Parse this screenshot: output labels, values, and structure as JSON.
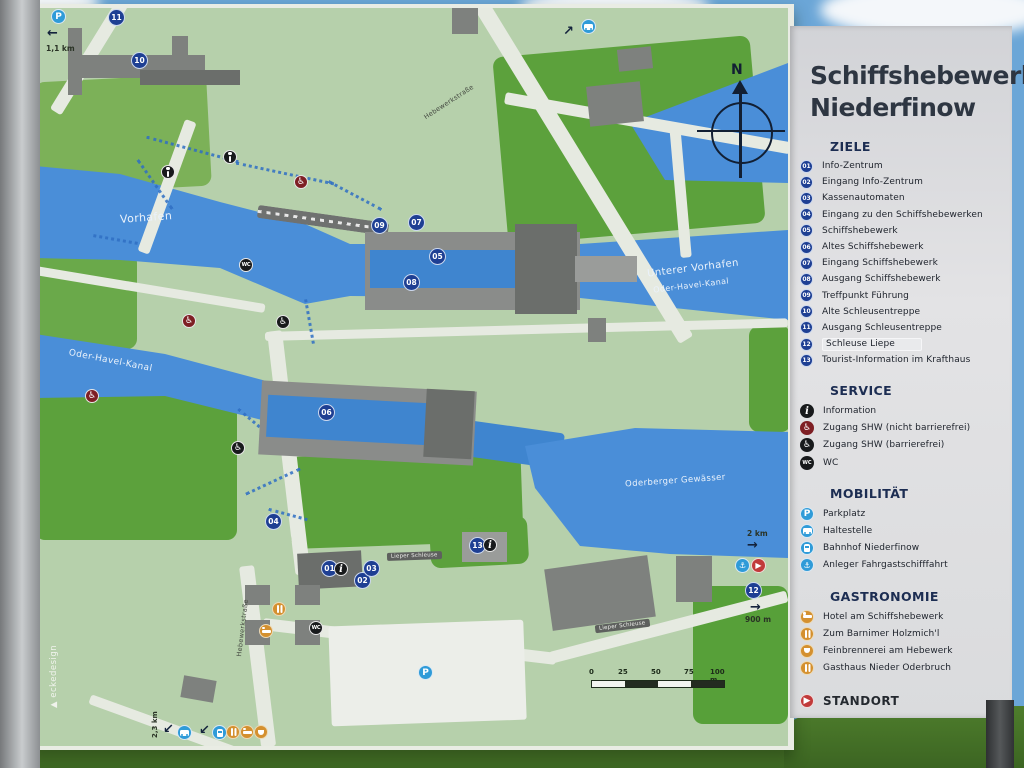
{
  "title": {
    "line1": "Schiffshebewerke",
    "line2": "Niederfinow"
  },
  "legend": {
    "ziele": {
      "header": "ZIELE",
      "items": [
        {
          "num": "01",
          "label": "Info-Zentrum"
        },
        {
          "num": "02",
          "label": "Eingang Info-Zentrum"
        },
        {
          "num": "03",
          "label": "Kassenautomaten"
        },
        {
          "num": "04",
          "label": "Eingang zu den Schiffshebewerken"
        },
        {
          "num": "05",
          "label": "Schiffshebewerk"
        },
        {
          "num": "06",
          "label": "Altes Schiffshebewerk"
        },
        {
          "num": "07",
          "label": "Eingang Schiffshebewerk"
        },
        {
          "num": "08",
          "label": "Ausgang Schiffshebewerk"
        },
        {
          "num": "09",
          "label": "Treffpunkt Führung"
        },
        {
          "num": "10",
          "label": "Alte Schleusentreppe"
        },
        {
          "num": "11",
          "label": "Ausgang Schleusentreppe"
        },
        {
          "num": "12",
          "label": "Schleuse Liepe"
        },
        {
          "num": "13",
          "label": "Tourist-Information im Krafthaus"
        }
      ]
    },
    "service": {
      "header": "SERVICE",
      "items": [
        {
          "label": "Information"
        },
        {
          "label": "Zugang SHW (nicht barrierefrei)"
        },
        {
          "label": "Zugang SHW (barrierefrei)"
        },
        {
          "label": "WC"
        }
      ]
    },
    "mobilitaet": {
      "header": "MOBILITÄT",
      "items": [
        {
          "label": "Parkplatz"
        },
        {
          "label": "Haltestelle"
        },
        {
          "label": "Bahnhof Niederfinow"
        },
        {
          "label": "Anleger Fahrgastschifffahrt"
        }
      ]
    },
    "gastronomie": {
      "header": "GASTRONOMIE",
      "items": [
        {
          "label": "Hotel am Schiffshebewerk"
        },
        {
          "label": "Zum Barnimer Holzmich'l"
        },
        {
          "label": "Feinbrennerei am Hebewerk"
        },
        {
          "label": "Gasthaus Nieder Oderbruch"
        }
      ]
    },
    "standort": {
      "label": "STANDORT"
    }
  },
  "map": {
    "water_labels": {
      "vorhafen": "Vorhafen",
      "unterer_vorhafen": "Unterer Vorhafen",
      "oder_havel_kanal": "Oder-Havel-Kanal",
      "oder_havel_kanal_west": "Oder-Havel-Kanal",
      "oderberger_gewaesser": "Oderberger Gewässer"
    },
    "road_labels": {
      "hebewerkstrasse_north": "Hebewerkstraße",
      "hebewerkstrasse_south": "Hebewerkstraße",
      "lieper_schleuse_1": "Lieper Schleuse",
      "lieper_schleuse_2": "Lieper Schleuse"
    },
    "markers": [
      "11",
      "10",
      "09",
      "07",
      "05",
      "08",
      "06",
      "04",
      "01",
      "02",
      "03",
      "13",
      "12"
    ],
    "distances": {
      "parkplatz_left": "1,1 km",
      "haltestelle_bottom": "2,3 km",
      "anleger_right": "2 km",
      "schleuse_right": "900 m"
    },
    "scalebar": {
      "ticks": [
        "0",
        "25",
        "50",
        "75",
        "100 m"
      ]
    },
    "credit": "▲ eckedesign"
  },
  "icons": {
    "north": "N",
    "parking": "P",
    "info": "i",
    "wc": "WC",
    "wheelchair": "♿",
    "anchor": "⚓",
    "standort_arrow": "▶",
    "arrow_left": "←",
    "arrow_up_right": "↗",
    "arrow_right": "→",
    "arrow_down_left": "↙"
  },
  "colors": {
    "water": "#4a8ed8",
    "map_green": "#b6d0ab",
    "bright_green": "#5ca13c",
    "marker_navy": "#1e3f93",
    "mobility_blue": "#2f9bd8",
    "gastro_orange": "#d4902f",
    "standort_red": "#c13a3a",
    "panel_gray": "#d8d9db"
  }
}
